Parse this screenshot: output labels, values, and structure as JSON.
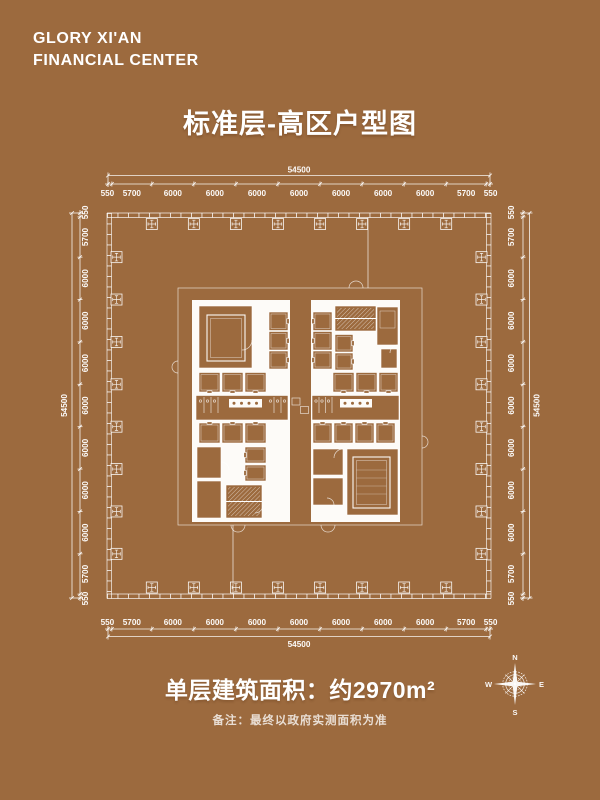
{
  "colors": {
    "background": "#9c6a3e",
    "ink": "#ffffff"
  },
  "header": {
    "logo_line1": "GLORY XI'AN",
    "logo_line2": "FINANCIAL CENTER"
  },
  "page_title": "标准层-高区户型图",
  "floor_plan": {
    "total_label": "54500",
    "total_mm": 54500,
    "segments_mm": [
      550,
      5700,
      6000,
      6000,
      6000,
      6000,
      6000,
      6000,
      6000,
      5700,
      550
    ]
  },
  "footer": {
    "area_label": "单层建筑面积：约2970m²",
    "note": "备注：最终以政府实测面积为准"
  },
  "compass": {
    "n": "N",
    "e": "E",
    "s": "S",
    "w": "W"
  }
}
